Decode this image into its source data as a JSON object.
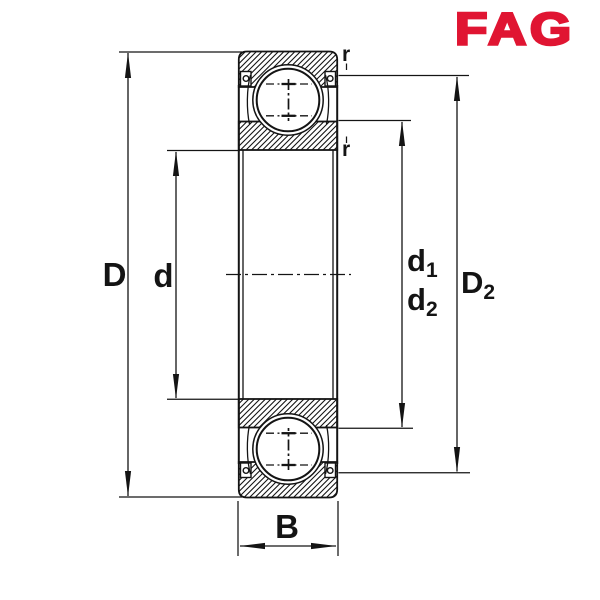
{
  "logo": {
    "text": "FAG",
    "color": "#E01532"
  },
  "dimensions": {
    "outer_diameter": {
      "label": "D"
    },
    "bore_diameter": {
      "label": "d"
    },
    "d1": {
      "main": "d",
      "sub": "1"
    },
    "d2": {
      "main": "d",
      "sub": "2"
    },
    "D2": {
      "main": "D",
      "sub": "2"
    },
    "width": {
      "label": "B"
    },
    "corner_radius_outer": {
      "label": "r"
    },
    "corner_radius_inner": {
      "label": "r"
    }
  },
  "colors": {
    "line": "#141414",
    "background": "#ffffff",
    "logo_red": "#E01532"
  }
}
